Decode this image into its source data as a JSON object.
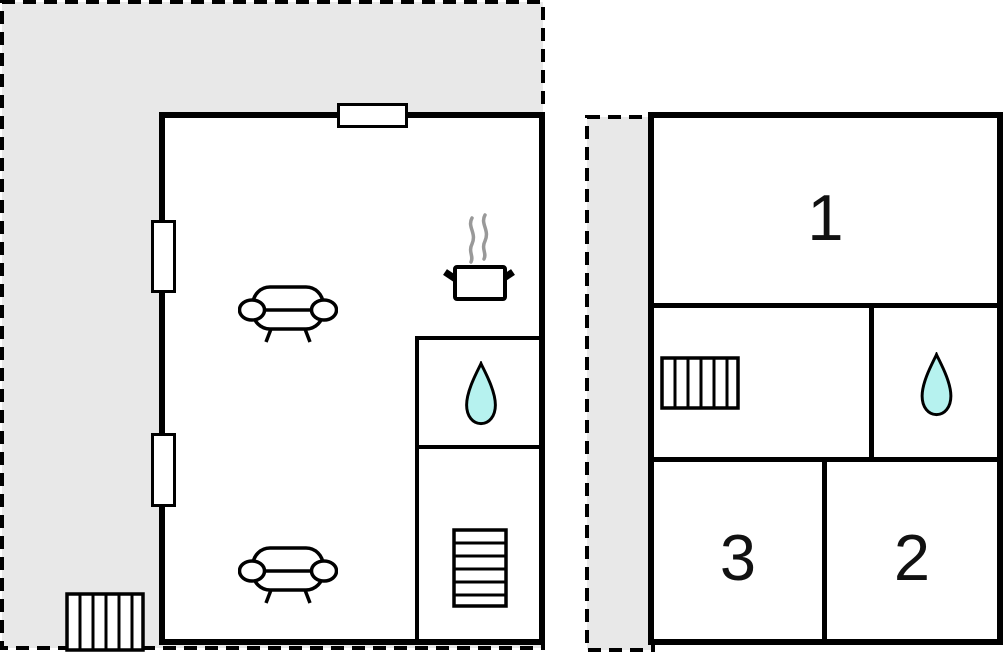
{
  "floor_plan": {
    "title": "two-level property floor plan",
    "colors": {
      "terrace_fill": "#e8e8e8",
      "wall": "#000000",
      "room_background": "#ffffff",
      "water_drop_fill": "#b6f2ef",
      "steam": "#999999"
    },
    "ground_floor": {
      "features": {
        "terrace": "dashed outdoor area",
        "sofas": 2,
        "stove_pot": "steaming pot (kitchen)",
        "water_drop": "bathroom",
        "staircase": "stairs to upper floor",
        "terrace_steps": "outdoor steps",
        "windows": 3
      }
    },
    "upper_floor": {
      "rooms": [
        {
          "label": "1"
        },
        {
          "label": "2"
        },
        {
          "label": "3"
        }
      ],
      "features": {
        "landing_steps": "stairs landing",
        "water_drop": "bathroom"
      }
    }
  }
}
